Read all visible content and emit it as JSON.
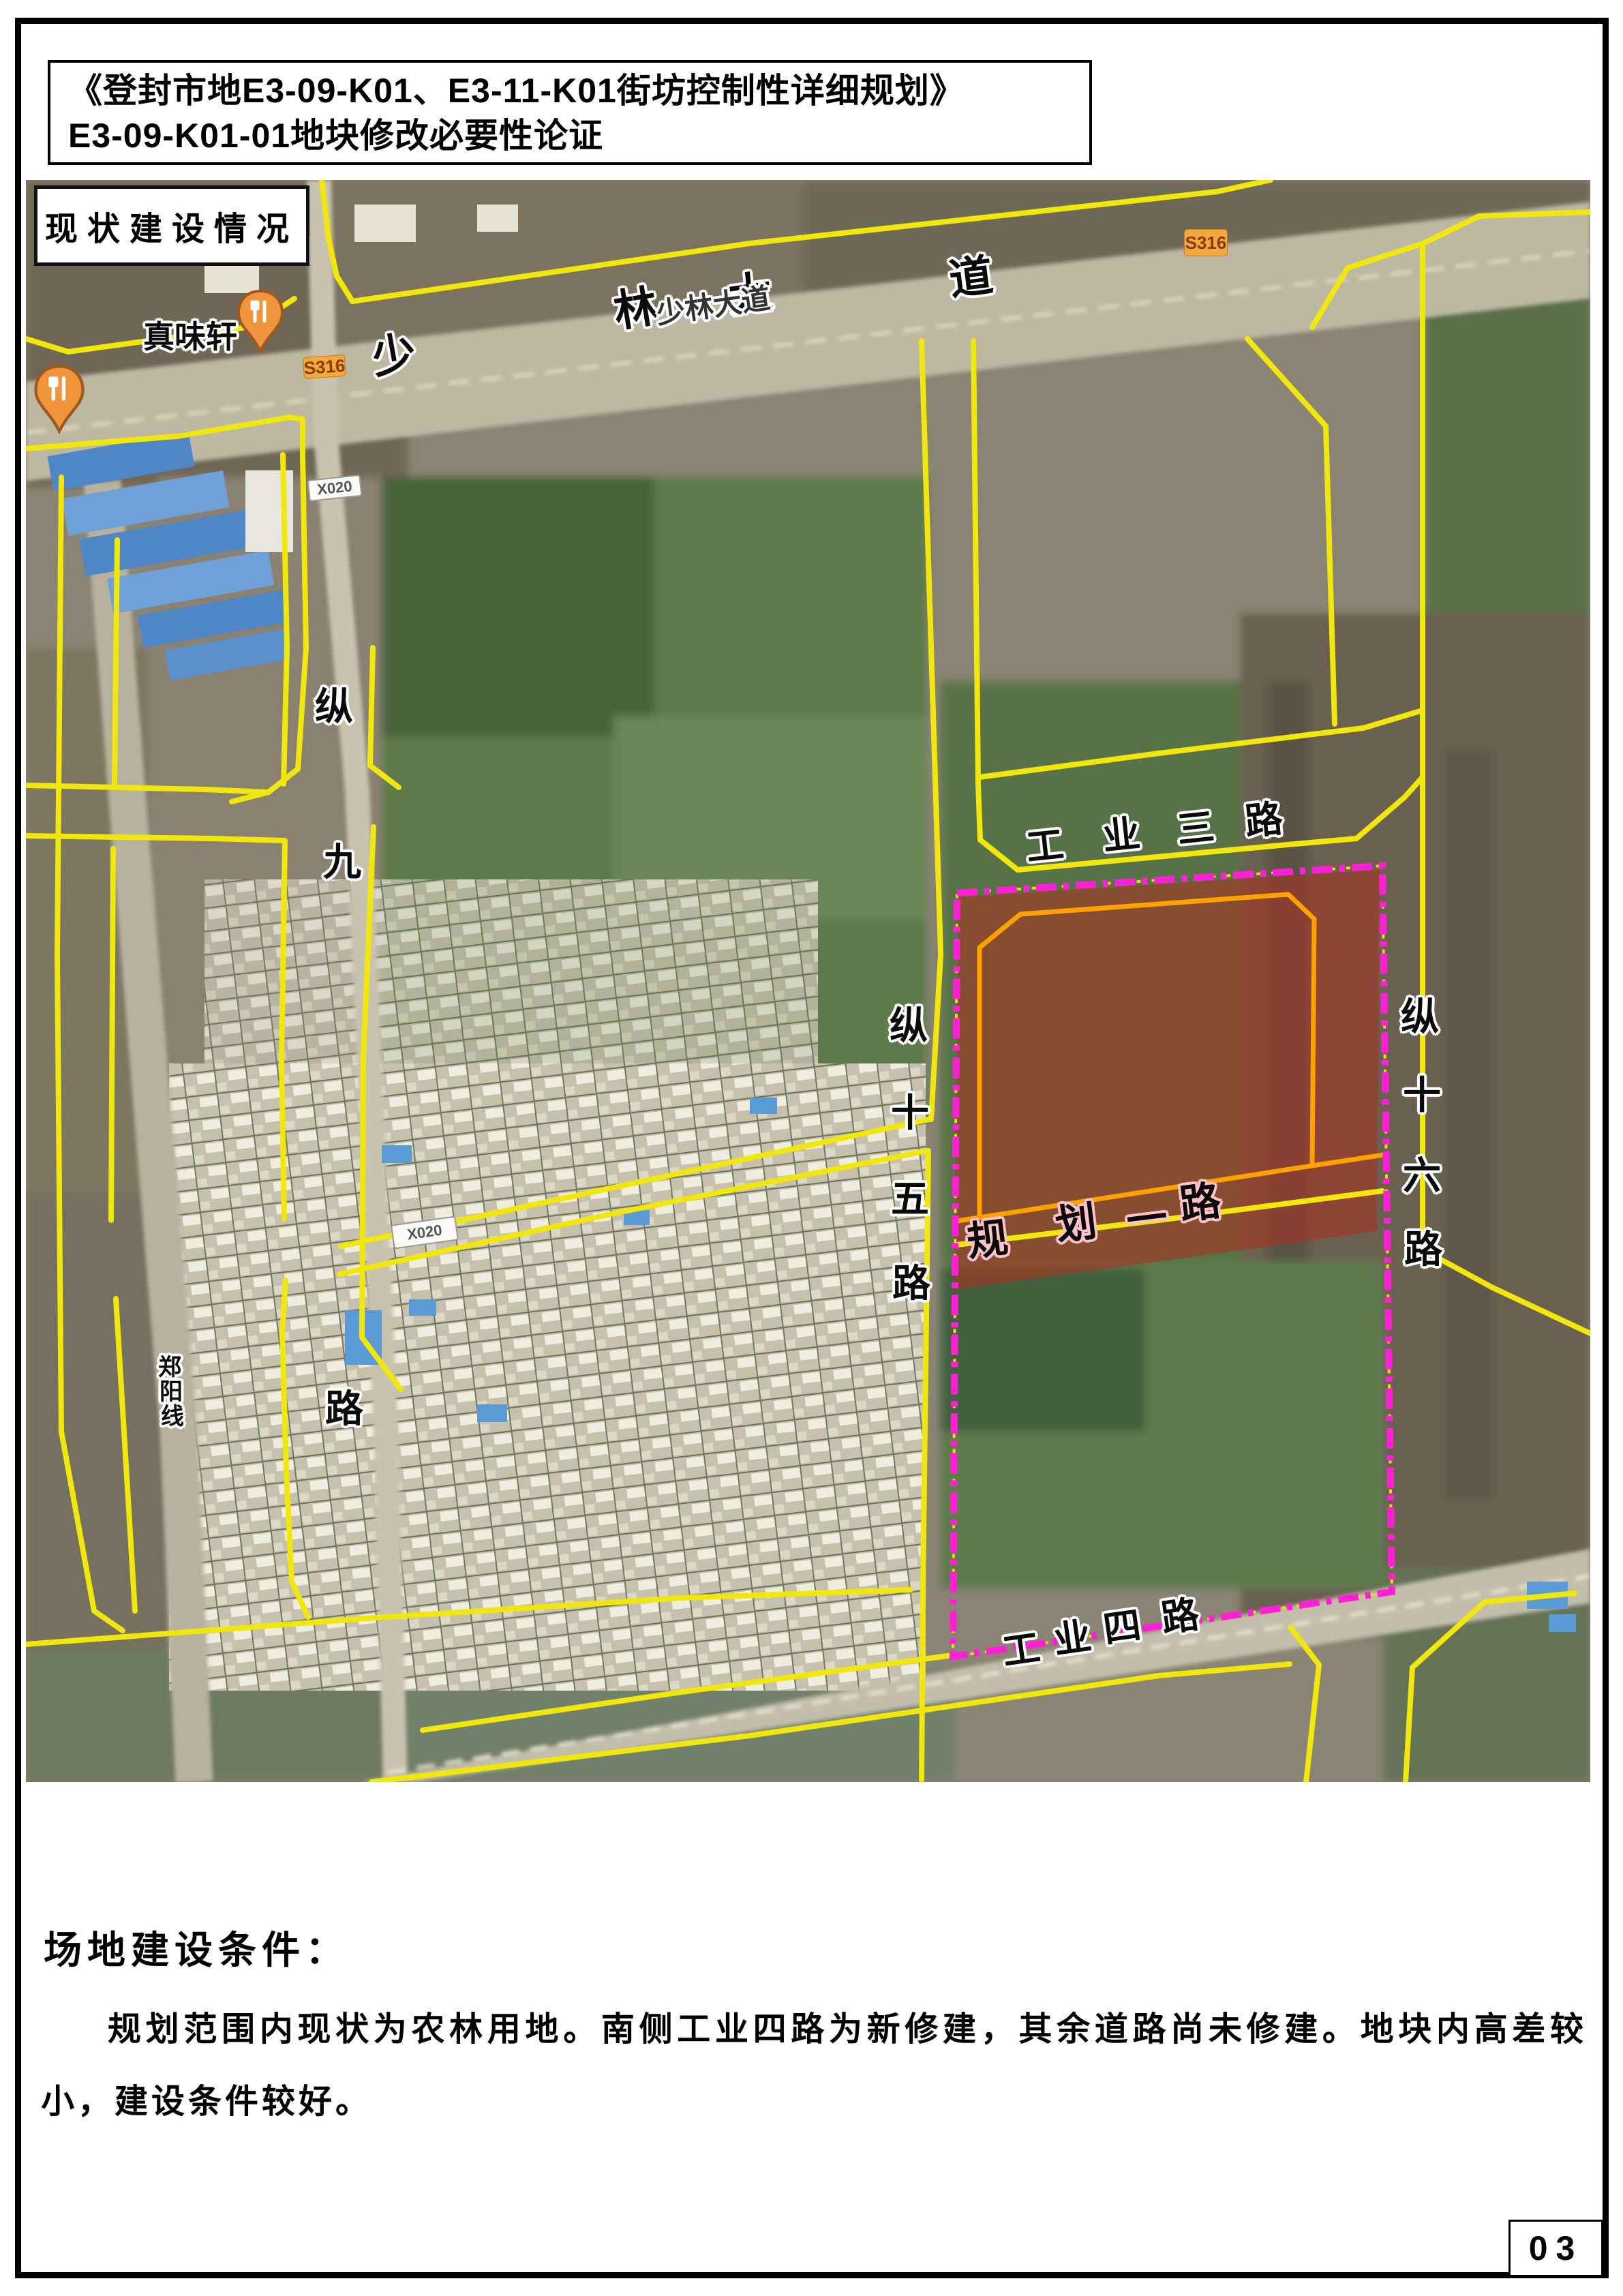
{
  "page": {
    "title_line1": "《登封市地E3-09-K01、E3-11-K01街坊控制性详细规划》",
    "title_line2": "E3-09-K01-01地块修改必要性论证",
    "page_number": "03"
  },
  "map": {
    "status_label": "现状建设情况",
    "roads": {
      "shaolin_avenue": {
        "chars": [
          "少",
          "林",
          "大",
          "道"
        ],
        "map_label": "少林大道"
      },
      "gongye_3rd": {
        "chars": [
          "工",
          "业",
          "三",
          "路"
        ]
      },
      "gongye_4th": {
        "chars": [
          "工",
          "业",
          "四",
          "路"
        ]
      },
      "guihua_1st": {
        "chars": [
          "规",
          "划",
          "一",
          "路"
        ]
      },
      "zong_9th": {
        "chars": [
          "纵",
          "九",
          "路"
        ]
      },
      "zong_15th": {
        "chars": [
          "纵",
          "十",
          "五",
          "路"
        ]
      },
      "zong_16th": {
        "chars": [
          "纵",
          "十",
          "六",
          "路"
        ]
      },
      "zhengyang_line": {
        "chars": [
          "郑",
          "阳",
          "线"
        ]
      }
    },
    "badges": {
      "s316": "S316",
      "x020": "X020"
    },
    "poi": {
      "restaurant_name": "真味轩"
    },
    "colors": {
      "planned_road_yellow": "#f2e70c",
      "plot_boundary_magenta": "#ff1fd4",
      "plot_fill_red": "#a83222",
      "inner_boundary_orange": "#ffa200",
      "guihua_label_stroke_pink": "#ffc2cc",
      "s316_badge_orange": "#f3a93e"
    }
  },
  "footer": {
    "heading": "场地建设条件：",
    "paragraph": "规划范围内现状为农林用地。南侧工业四路为新修建，其余道路尚未修建。地块内高差较小，建设条件较好。"
  }
}
